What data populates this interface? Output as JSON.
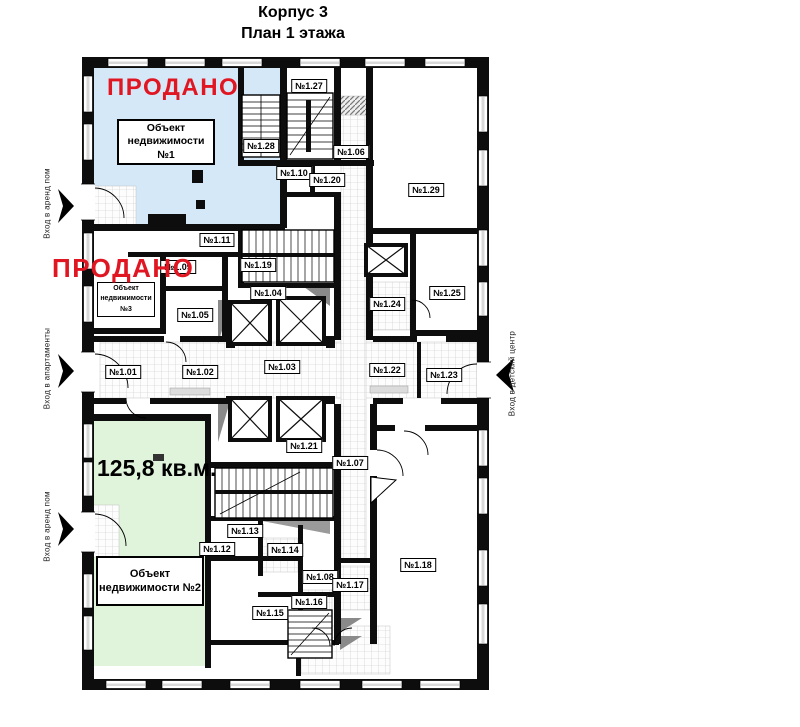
{
  "title": {
    "building": "Корпус 3",
    "floor": "План 1 этажа"
  },
  "colors": {
    "sold": "#e01722",
    "zone1": "#d5e8f8",
    "zone2": "#e0f4dc"
  },
  "sold_labels": {
    "top": "ПРОДАНО",
    "middle": "ПРОДАНО"
  },
  "objects": {
    "object1": "Объект недвижимости №1",
    "object2": "Объект недвижимости №2",
    "object3": "Объект недвижимости №3"
  },
  "area_label": "125,8 кв.м.",
  "entrances": {
    "left_top": "Вход в аренд пом",
    "left_middle": "Вход в апартаменты",
    "left_bottom": "Вход в аренд пом",
    "right": "Вход в детский центр"
  },
  "rooms": [
    {
      "label": "№1.01",
      "x": 123,
      "y": 372
    },
    {
      "label": "№1.02",
      "x": 200,
      "y": 372
    },
    {
      "label": "№1.03",
      "x": 282,
      "y": 367
    },
    {
      "label": "№1.04",
      "x": 268,
      "y": 293
    },
    {
      "label": "№1.05",
      "x": 195,
      "y": 315
    },
    {
      "label": "№1.06",
      "x": 351,
      "y": 152
    },
    {
      "label": "№1.07",
      "x": 350,
      "y": 463
    },
    {
      "label": "№1.08",
      "x": 320,
      "y": 577
    },
    {
      "label": "№1.09",
      "x": 178,
      "y": 267
    },
    {
      "label": "№1.10",
      "x": 294,
      "y": 173
    },
    {
      "label": "№1.11",
      "x": 217,
      "y": 240
    },
    {
      "label": "№1.12",
      "x": 217,
      "y": 549
    },
    {
      "label": "№1.13",
      "x": 245,
      "y": 531
    },
    {
      "label": "№1.14",
      "x": 285,
      "y": 550
    },
    {
      "label": "№1.15",
      "x": 270,
      "y": 613
    },
    {
      "label": "№1.16",
      "x": 309,
      "y": 602
    },
    {
      "label": "№1.17",
      "x": 350,
      "y": 585
    },
    {
      "label": "№1.18",
      "x": 418,
      "y": 565
    },
    {
      "label": "№1.19",
      "x": 258,
      "y": 265
    },
    {
      "label": "№1.20",
      "x": 327,
      "y": 180
    },
    {
      "label": "№1.21",
      "x": 304,
      "y": 446
    },
    {
      "label": "№1.22",
      "x": 387,
      "y": 370
    },
    {
      "label": "№1.23",
      "x": 444,
      "y": 375
    },
    {
      "label": "№1.24",
      "x": 387,
      "y": 304
    },
    {
      "label": "№1.25",
      "x": 447,
      "y": 293
    },
    {
      "label": "№1.27",
      "x": 309,
      "y": 86
    },
    {
      "label": "№1.28",
      "x": 261,
      "y": 146
    },
    {
      "label": "№1.29",
      "x": 426,
      "y": 190
    }
  ]
}
